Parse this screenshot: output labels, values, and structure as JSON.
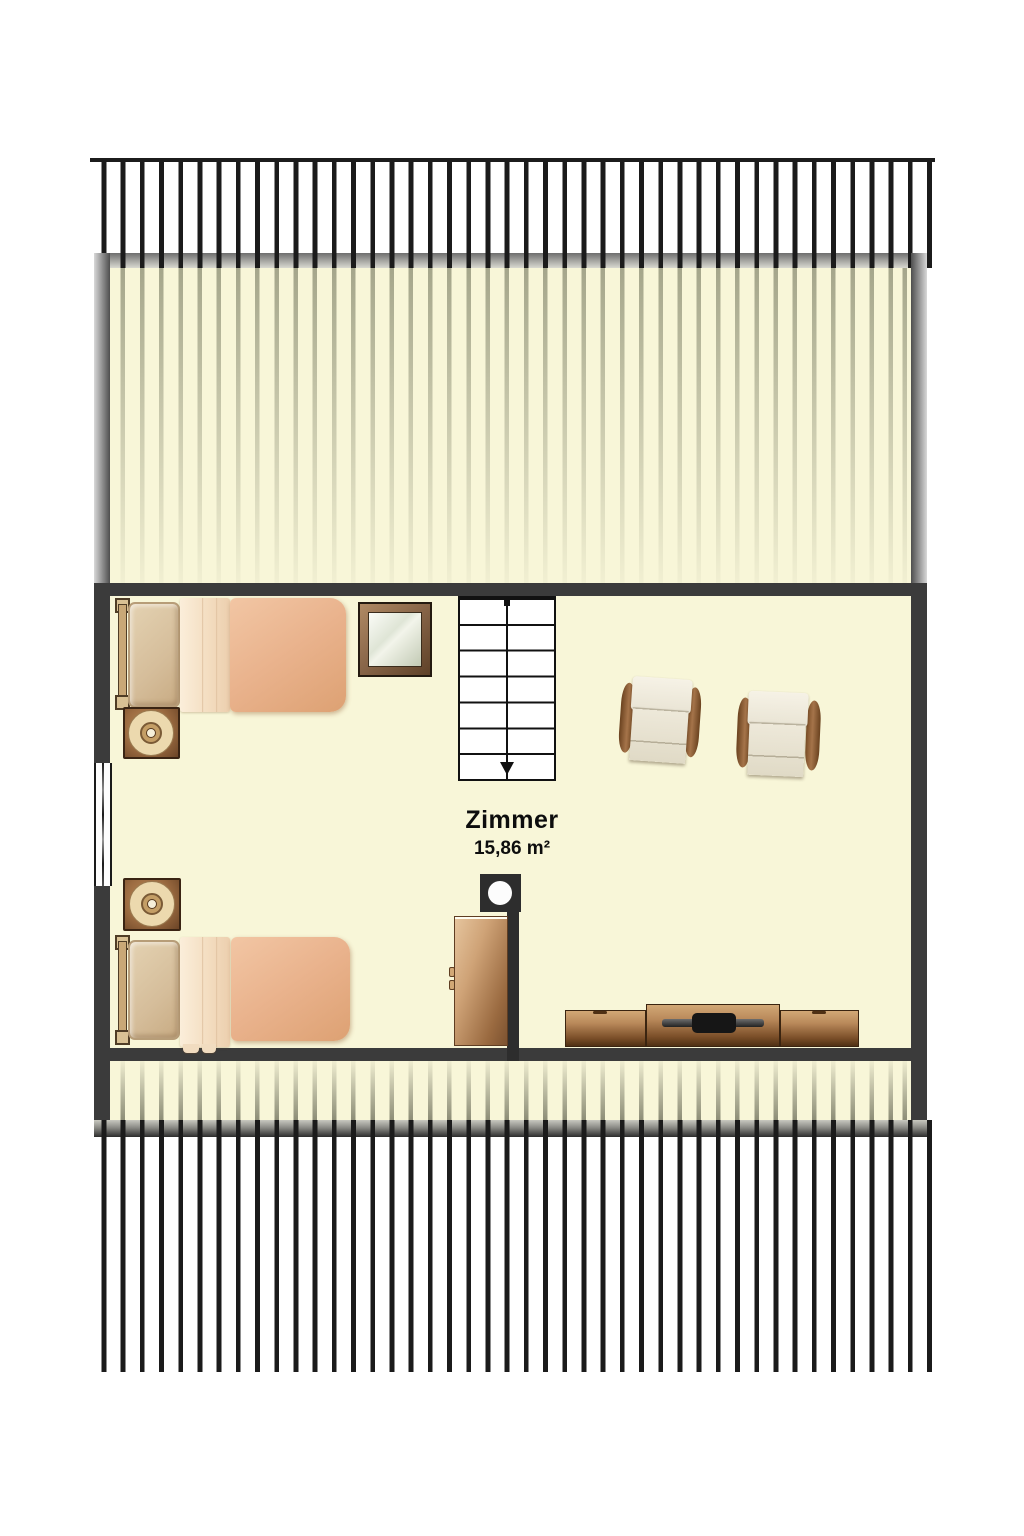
{
  "room": {
    "label": "Zimmer",
    "area": "15,86 m²"
  },
  "palette": {
    "background": "#ffffff",
    "floor_cream": "#f8f6d8",
    "wall_dark": "#3b3b3b",
    "rafter_stripe": "#1b1b1b",
    "slope_stripe": "rgba(82,86,62,0.5)",
    "wood_light": "#d2a876",
    "wood_dark": "#4f3014",
    "duvet_peach": "#e9b28c",
    "sheet_cream": "#f3dcbf",
    "pillow_tan": "#d5bd9a",
    "cushion_white": "#eee9da",
    "stair_line": "#111111",
    "chimney_dark": "#2d2d2d"
  },
  "furniture": [
    "single-bed-top",
    "nightstand-with-lamp-top",
    "wall-mirror",
    "staircase-down",
    "armchair-left",
    "armchair-right",
    "roof-window",
    "nightstand-with-lamp-bottom",
    "single-bed-bottom",
    "chimney-with-flue",
    "wardrobe",
    "tv-sideboard"
  ]
}
